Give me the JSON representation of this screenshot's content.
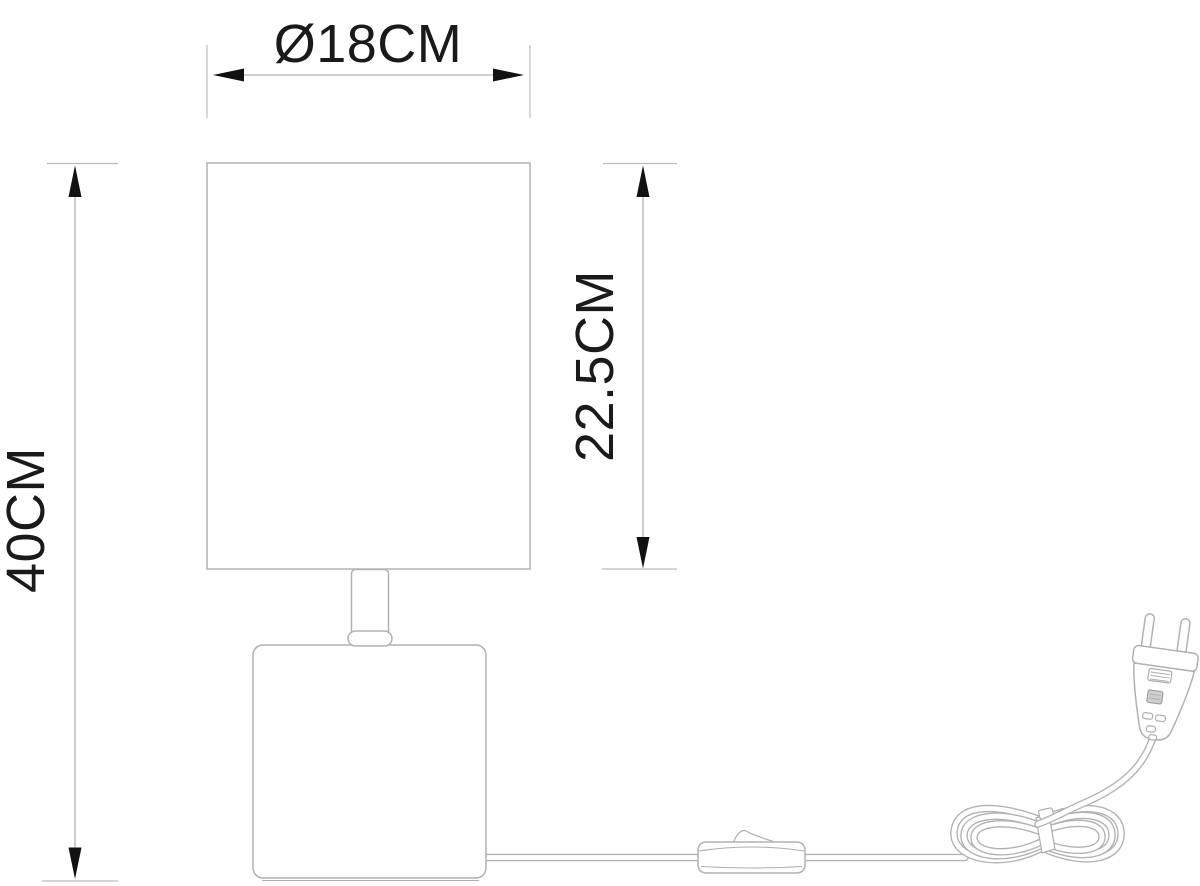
{
  "diagram": {
    "kind": "technical dimension drawing of a table lamp with cord, inline switch and EU plug",
    "dimensions": {
      "shade_diameter": {
        "label": "Ø18CM",
        "value_cm": 18
      },
      "shade_height": {
        "label": "22.5CM",
        "value_cm": 22.5
      },
      "total_height": {
        "label": "40CM",
        "value_cm": 40
      }
    },
    "colors": {
      "background": "#ffffff",
      "drawing_outline": "#b2b2b2",
      "annotation_text": "#1a1a1a",
      "arrowheads": "#111111"
    }
  }
}
